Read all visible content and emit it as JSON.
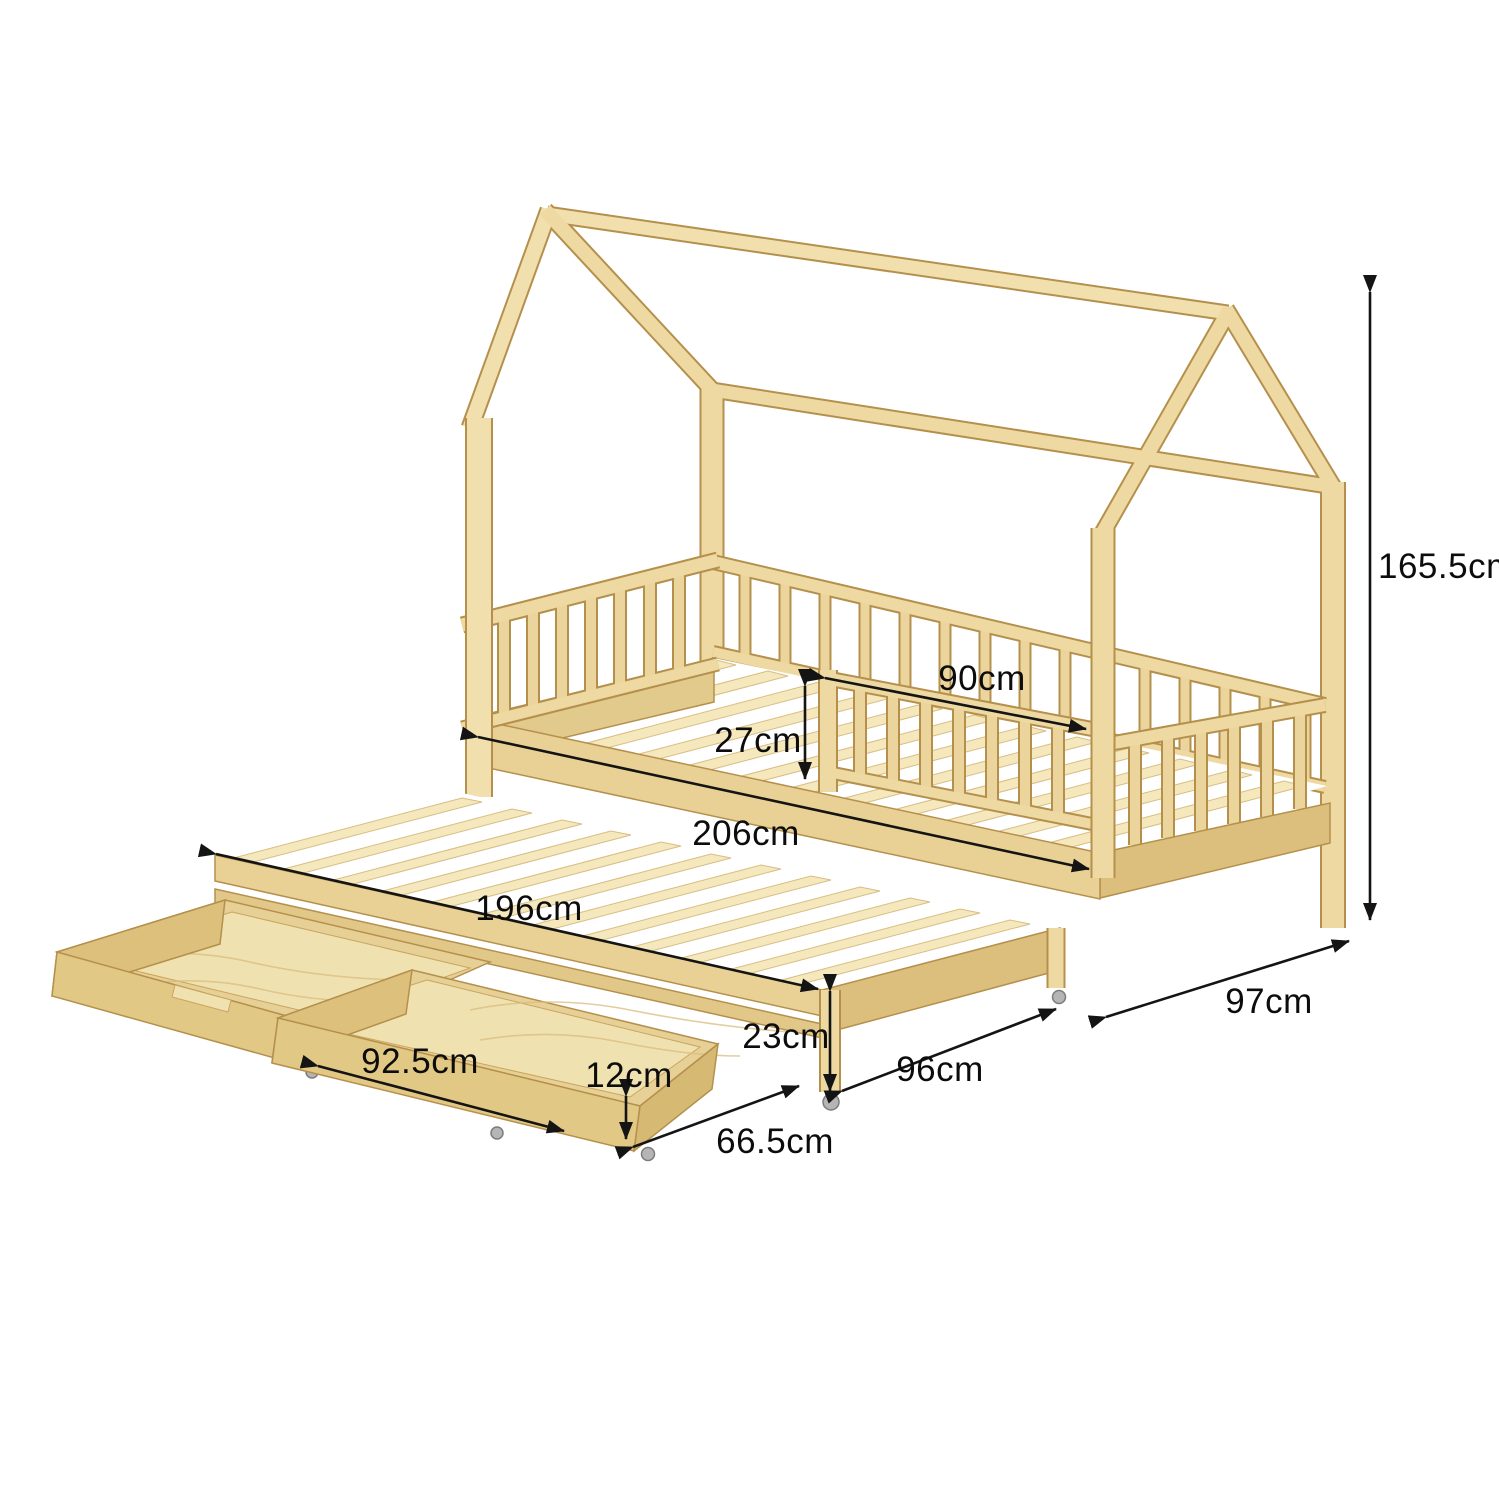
{
  "dims": {
    "total_height": "165.5cm",
    "guardrail_length": "90cm",
    "frame_height": "27cm",
    "bed_length": "206cm",
    "trundle_length": "196cm",
    "bed_width": "97cm",
    "trundle_width": "96cm",
    "trundle_height": "23cm",
    "drawer_length": "92.5cm",
    "drawer_height": "12cm",
    "drawer_width": "66.5cm"
  },
  "colors": {
    "wood": "#eed9a2",
    "wood_outline": "#b5904c",
    "dimension_line": "#141414",
    "background": "#ffffff"
  }
}
